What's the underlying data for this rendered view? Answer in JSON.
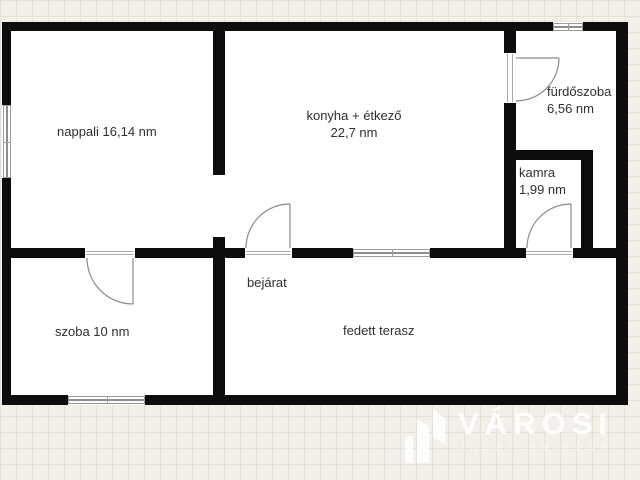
{
  "rooms": {
    "nappali": {
      "label": "nappali 16,14 nm"
    },
    "konyha": {
      "label": "konyha + étkező",
      "area": "22,7 nm"
    },
    "furdoszoba": {
      "label": "fürdőszoba",
      "area": "6,56 nm"
    },
    "kamra": {
      "label": "kamra",
      "area": "1,99 nm"
    },
    "szoba": {
      "label": "szoba 10 nm"
    },
    "bejarat": {
      "label": "bejárat"
    },
    "fedett_terasz": {
      "label": "fedett terasz"
    }
  },
  "watermark": {
    "brand": "VÁROSI",
    "tagline": "INGATLANIRODA"
  },
  "colors": {
    "wall": "#0d0d0d",
    "floor": "#ffffff",
    "background": "#f2f0e9",
    "grid_line": "#e4e1d7",
    "door_line": "#8a8a8a",
    "label_text": "#332f2d",
    "watermark": "#ffffff"
  }
}
